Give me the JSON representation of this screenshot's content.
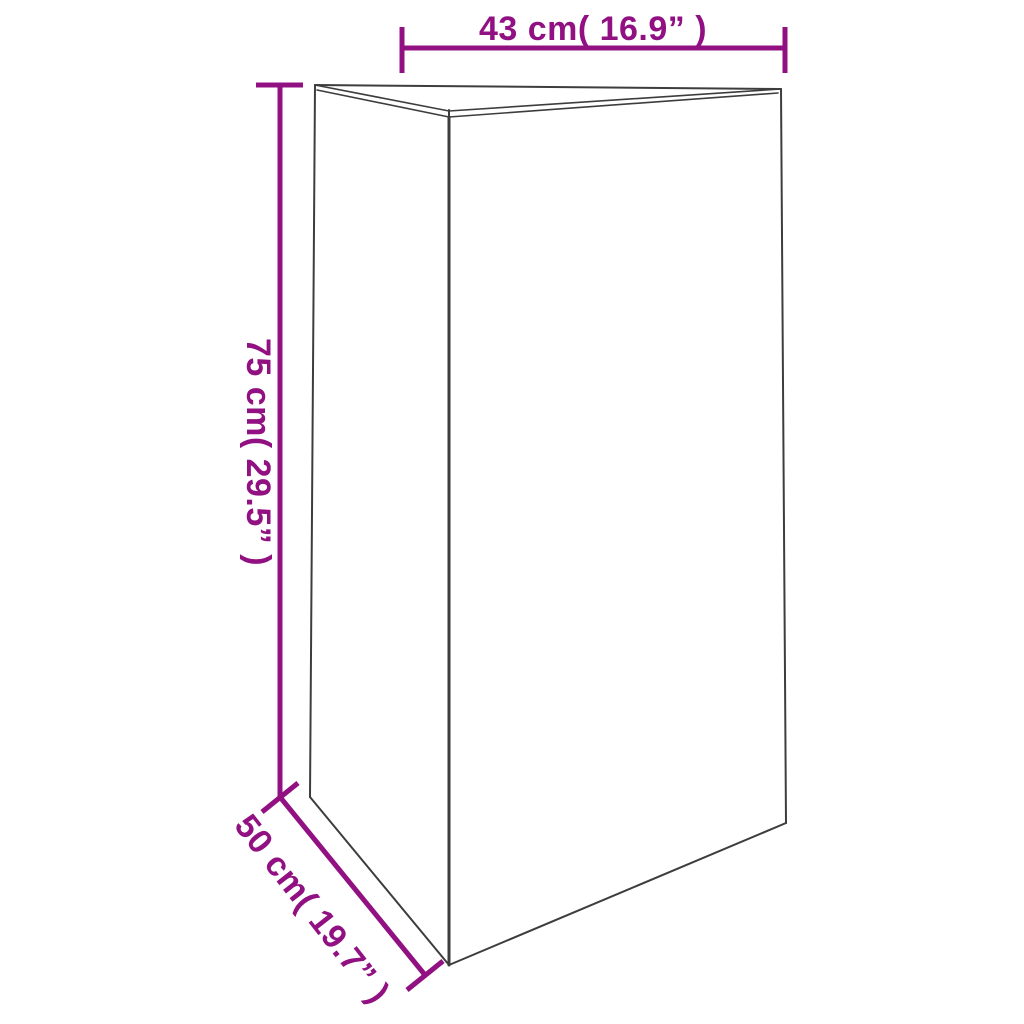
{
  "diagram": {
    "type": "product-dimension-diagram",
    "shape": "triangular-prism",
    "labels": {
      "width": "43 cm( 16.9” )",
      "height": "75 cm( 29.5” )",
      "depth": "50 cm( 19.7” )"
    },
    "values": {
      "width_cm": 43,
      "width_in": 16.9,
      "height_cm": 75,
      "height_in": 29.5,
      "depth_cm": 50,
      "depth_in": 19.7
    },
    "colors": {
      "dimension": "#911082",
      "outline": "#3d3d3d",
      "background": "#ffffff"
    }
  }
}
